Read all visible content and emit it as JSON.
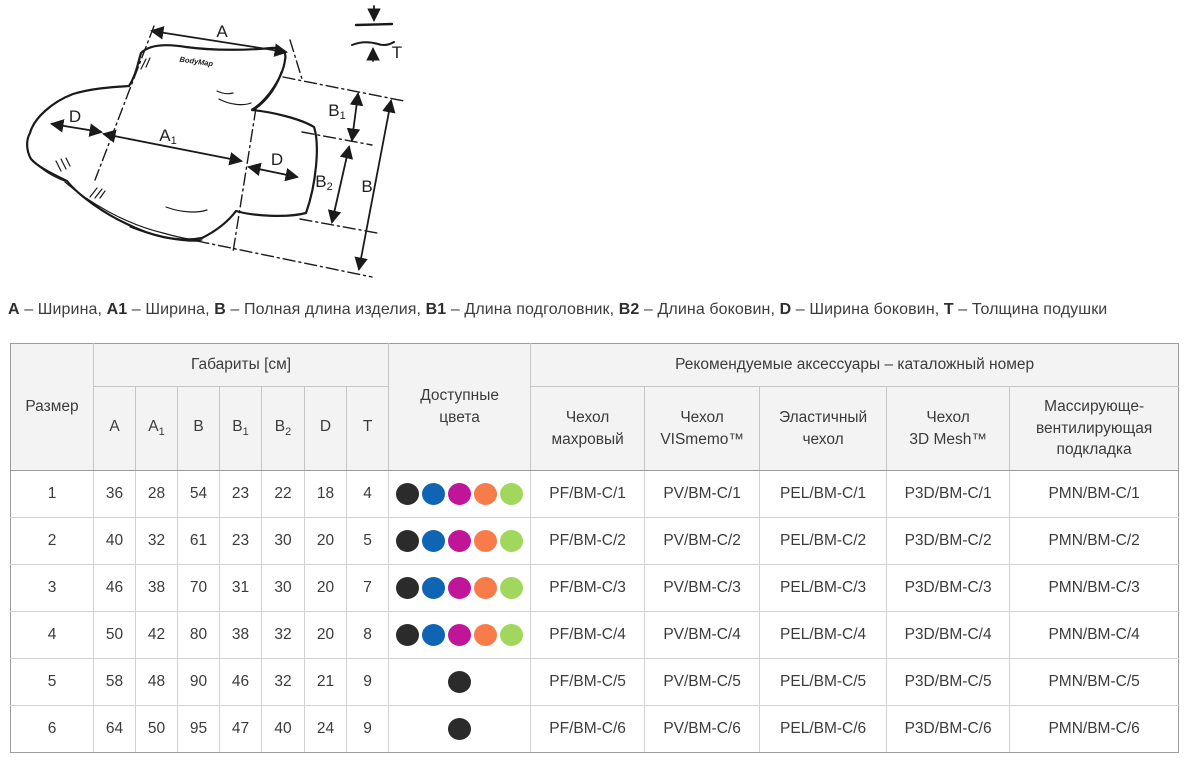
{
  "diagram": {
    "logo": "BodyMap",
    "labels": {
      "a": {
        "base": "A",
        "sub": ""
      },
      "a1": {
        "base": "A",
        "sub": "1"
      },
      "b": {
        "base": "B",
        "sub": ""
      },
      "b1": {
        "base": "B",
        "sub": "1"
      },
      "b2": {
        "base": "B",
        "sub": "2"
      },
      "d": {
        "base": "D",
        "sub": ""
      },
      "t": {
        "base": "T",
        "sub": ""
      }
    }
  },
  "legend": {
    "separator": "–",
    "items": [
      {
        "term": "A",
        "desc": "Ширина"
      },
      {
        "term": "A1",
        "desc": "Ширина"
      },
      {
        "term": "B",
        "desc": "Полная длина изделия"
      },
      {
        "term": "B1",
        "desc": "Длина подголовник"
      },
      {
        "term": "B2",
        "desc": "Длина боковин"
      },
      {
        "term": "D",
        "desc": "Ширина боковин"
      },
      {
        "term": "T",
        "desc": "Толщина подушки"
      }
    ]
  },
  "table": {
    "header": {
      "size": "Размер",
      "dimensions_group": "Габариты [см]",
      "colors": "Доступные\nцвета",
      "accessories_group": "Рекомендуемые аксессуары – каталожный номер",
      "dim_columns": [
        {
          "base": "A",
          "sub": ""
        },
        {
          "base": "A",
          "sub": "1"
        },
        {
          "base": "B",
          "sub": ""
        },
        {
          "base": "B",
          "sub": "1"
        },
        {
          "base": "B",
          "sub": "2"
        },
        {
          "base": "D",
          "sub": ""
        },
        {
          "base": "T",
          "sub": ""
        }
      ],
      "accessory_columns": [
        "Чехол\nмахровый",
        "Чехол\nVISmemo™",
        "Эластичный\nчехол",
        "Чехол\n3D Mesh™",
        "Массирующе-\nвентилирующая\nподкладка"
      ]
    },
    "color_palette": {
      "black": "#2b2b2b",
      "blue": "#1064b4",
      "magenta": "#c01598",
      "orange": "#f87c49",
      "green": "#a0d75c"
    },
    "rows": [
      {
        "size": "1",
        "dims": [
          "36",
          "28",
          "54",
          "23",
          "22",
          "18",
          "4"
        ],
        "colors": [
          "black",
          "blue",
          "magenta",
          "orange",
          "green"
        ],
        "accessories": [
          "PF/BM-C/1",
          "PV/BM-C/1",
          "PEL/BM-C/1",
          "P3D/BM-C/1",
          "PMN/BM-C/1"
        ]
      },
      {
        "size": "2",
        "dims": [
          "40",
          "32",
          "61",
          "23",
          "30",
          "20",
          "5"
        ],
        "colors": [
          "black",
          "blue",
          "magenta",
          "orange",
          "green"
        ],
        "accessories": [
          "PF/BM-C/2",
          "PV/BM-C/2",
          "PEL/BM-C/2",
          "P3D/BM-C/2",
          "PMN/BM-C/2"
        ]
      },
      {
        "size": "3",
        "dims": [
          "46",
          "38",
          "70",
          "31",
          "30",
          "20",
          "7"
        ],
        "colors": [
          "black",
          "blue",
          "magenta",
          "orange",
          "green"
        ],
        "accessories": [
          "PF/BM-C/3",
          "PV/BM-C/3",
          "PEL/BM-C/3",
          "P3D/BM-C/3",
          "PMN/BM-C/3"
        ]
      },
      {
        "size": "4",
        "dims": [
          "50",
          "42",
          "80",
          "38",
          "32",
          "20",
          "8"
        ],
        "colors": [
          "black",
          "blue",
          "magenta",
          "orange",
          "green"
        ],
        "accessories": [
          "PF/BM-C/4",
          "PV/BM-C/4",
          "PEL/BM-C/4",
          "P3D/BM-C/4",
          "PMN/BM-C/4"
        ]
      },
      {
        "size": "5",
        "dims": [
          "58",
          "48",
          "90",
          "46",
          "32",
          "21",
          "9"
        ],
        "colors": [
          "black"
        ],
        "accessories": [
          "PF/BM-C/5",
          "PV/BM-C/5",
          "PEL/BM-C/5",
          "P3D/BM-C/5",
          "PMN/BM-C/5"
        ]
      },
      {
        "size": "6",
        "dims": [
          "64",
          "50",
          "95",
          "47",
          "40",
          "24",
          "9"
        ],
        "colors": [
          "black"
        ],
        "accessories": [
          "PF/BM-C/6",
          "PV/BM-C/6",
          "PEL/BM-C/6",
          "P3D/BM-C/6",
          "PMN/BM-C/6"
        ]
      }
    ]
  }
}
